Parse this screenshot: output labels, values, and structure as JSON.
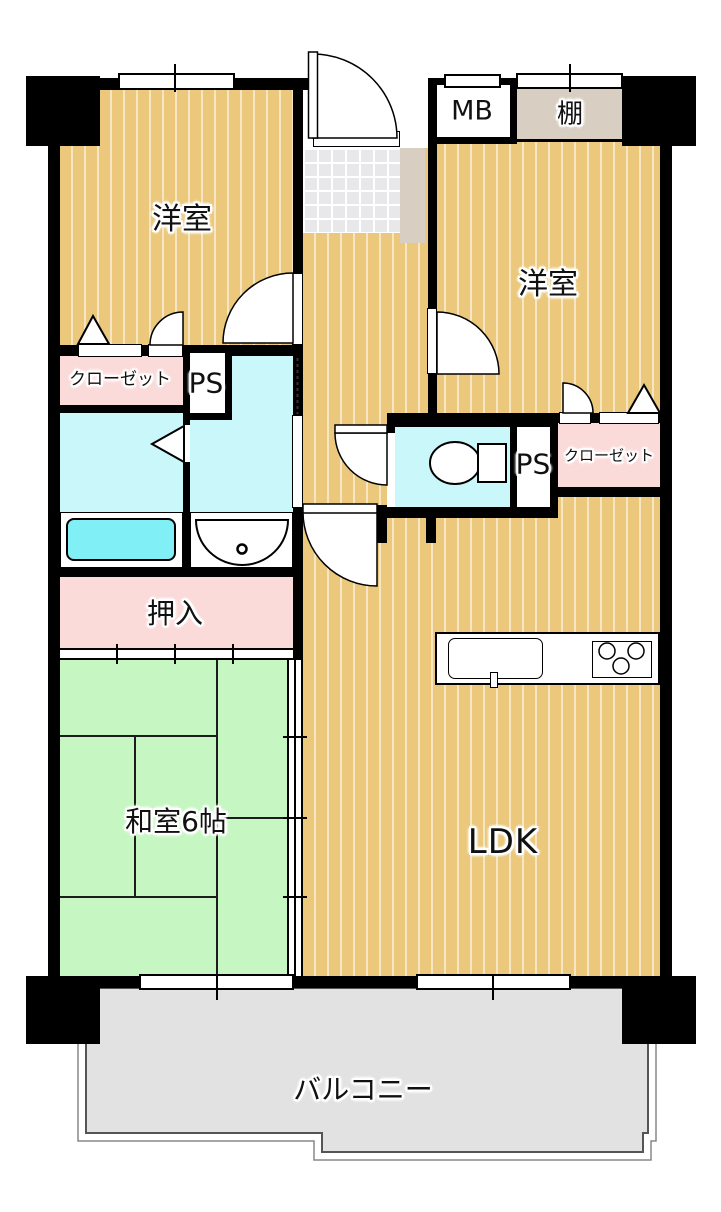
{
  "plan": {
    "title": "apartment-floor-plan",
    "rooms": {
      "bedroom_left": "洋室",
      "bedroom_right": "洋室",
      "tatami_room": "和室6帖",
      "ldk": "LDK",
      "balcony": "バルコニー",
      "futon_closet": "押入",
      "closet_left": "クローゼット",
      "closet_right": "クローゼット",
      "pipe_space_left": "PS",
      "pipe_space_right": "PS",
      "meter_box": "MB",
      "shelf": "棚"
    },
    "colors": {
      "flooring": "#ebc87b",
      "tatami": "#c6f7c3",
      "wet_area": "#c9f7fa",
      "bathtub": "#80f0f6",
      "closet_pink": "#fbdada",
      "balcony_gray": "#e2e2e2",
      "shelf_beige": "#d8cfc2",
      "entry_tile": "#e8e8eb",
      "wall": "#000000"
    }
  }
}
